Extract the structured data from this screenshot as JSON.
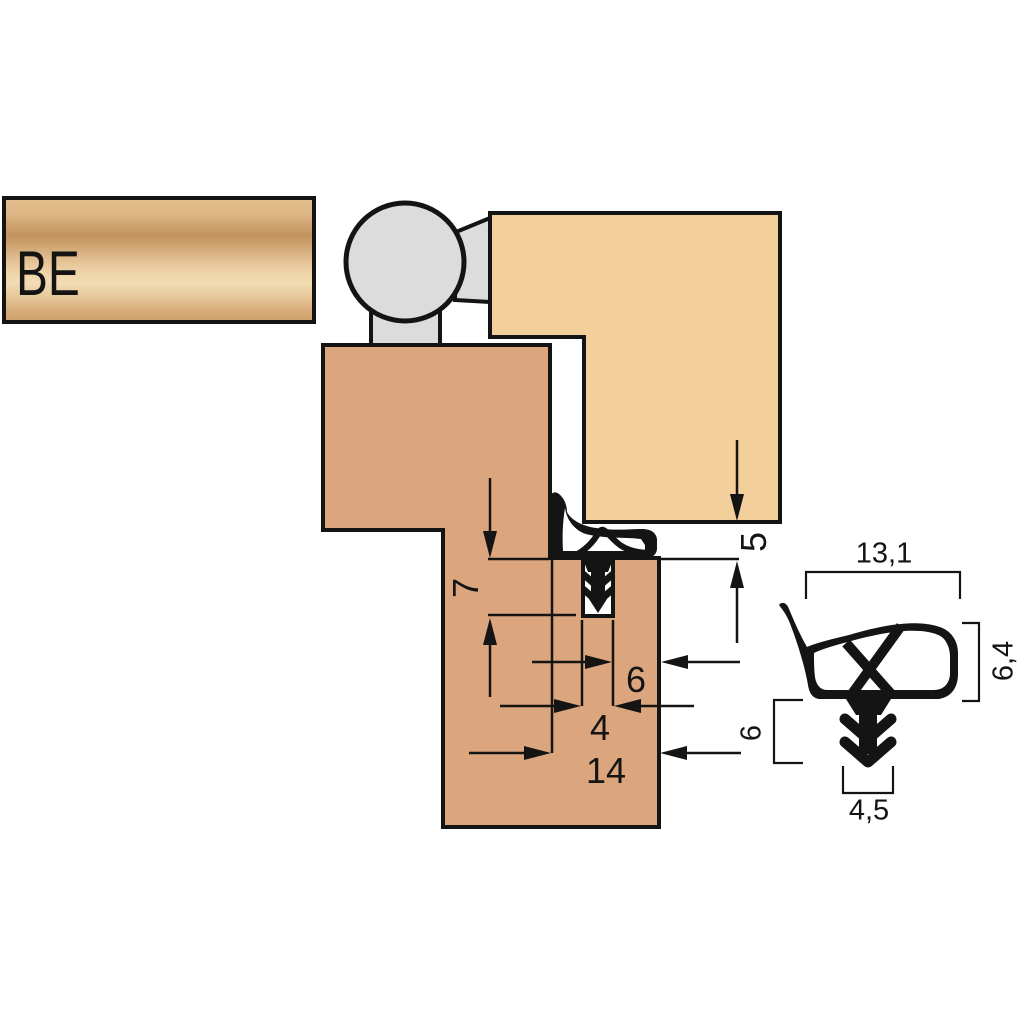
{
  "diagram": {
    "product_code": "BE",
    "main_view_dimensions": {
      "groove_depth": "7",
      "clearance_gap": "5",
      "edge_distance": "6",
      "groove_width": "4",
      "rabbet_width": "14"
    },
    "profile_detail_dimensions": {
      "overall_width": "13,1",
      "bulb_height": "6,4",
      "stem_height": "6",
      "stem_width": "4,5"
    },
    "colors": {
      "door_wood": "#dba57d",
      "frame_wood": "#f2cf9b",
      "hinge_gray": "#dcdcdc",
      "seal_black": "#141414",
      "outline": "#141414",
      "plate_base": "#e2bc8b",
      "plate_shadow": "#c2935f",
      "plate_highlight": "#f2dcb4"
    }
  }
}
